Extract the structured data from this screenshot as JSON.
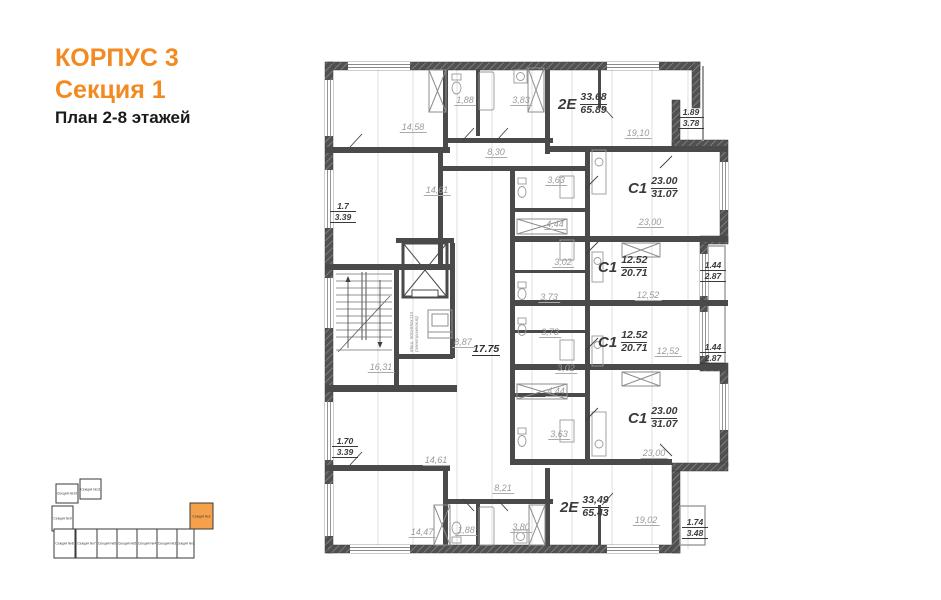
{
  "title": {
    "building": "КОРПУС 3",
    "section": "Секция 1",
    "plan": "План 2-8 этажей"
  },
  "colors": {
    "accent_orange": "#f28a21",
    "minimap_highlight": "#f5a04a",
    "wall_dark": "#4a4a4a",
    "room_label_gray": "#9a9a9a"
  },
  "apartments": [
    {
      "type": "2Е",
      "area_living": "33.68",
      "area_total": "65.89"
    },
    {
      "type": "С1",
      "area_living": "23.00",
      "area_total": "31.07"
    },
    {
      "type": "С1",
      "area_living": "12.52",
      "area_total": "20.71"
    },
    {
      "type": "С1",
      "area_living": "12.52",
      "area_total": "20.71"
    },
    {
      "type": "С1",
      "area_living": "23.00",
      "area_total": "31.07"
    },
    {
      "type": "2Е",
      "area_living": "33,49",
      "area_total": "65.43"
    }
  ],
  "balconies": [
    {
      "top": "1.89",
      "bottom": "3.78"
    },
    {
      "top": "1.7",
      "bottom": "3.39"
    },
    {
      "top": "1.44",
      "bottom": "2.87"
    },
    {
      "top": "1.44",
      "bottom": "2.87"
    },
    {
      "top": "1.70",
      "bottom": "3.39"
    },
    {
      "top": "1.74",
      "bottom": "3.48"
    }
  ],
  "rooms": [
    {
      "label": "14,58"
    },
    {
      "label": "1,88"
    },
    {
      "label": "3,83"
    },
    {
      "label": "19,10"
    },
    {
      "label": "8,30"
    },
    {
      "label": "14,61"
    },
    {
      "label": "3,63"
    },
    {
      "label": "4,44"
    },
    {
      "label": "23,00"
    },
    {
      "label": "3,02"
    },
    {
      "label": "3,73"
    },
    {
      "label": "12,52"
    },
    {
      "label": "16,31"
    },
    {
      "label": "8,87"
    },
    {
      "label": "3,73"
    },
    {
      "label": "3,02"
    },
    {
      "label": "12,52"
    },
    {
      "label": "4,44"
    },
    {
      "label": "3,63"
    },
    {
      "label": "23,00"
    },
    {
      "label": "14,61"
    },
    {
      "label": "8,21"
    },
    {
      "label": "14,47"
    },
    {
      "label": "1,88"
    },
    {
      "label": "3,80"
    },
    {
      "label": "19,02"
    }
  ],
  "corridor": {
    "label": "17.75"
  },
  "elevator_note": {
    "line1": "Маш. 900х950х110",
    "line2": "(электрический)"
  },
  "minimap": {
    "sections": [
      {
        "label": "Секция №1",
        "highlighted": true
      },
      {
        "label": "Секция №2",
        "highlighted": false
      },
      {
        "label": "Секция №3",
        "highlighted": false
      },
      {
        "label": "Секция №4",
        "highlighted": false
      },
      {
        "label": "Секция №5",
        "highlighted": false
      },
      {
        "label": "Секция №6",
        "highlighted": false
      },
      {
        "label": "Секция №7",
        "highlighted": false
      },
      {
        "label": "Секция №8",
        "highlighted": false
      },
      {
        "label": "Секция №9",
        "highlighted": false
      },
      {
        "label": "Секция №10",
        "highlighted": false
      },
      {
        "label": "Секция №11",
        "highlighted": false
      }
    ]
  }
}
